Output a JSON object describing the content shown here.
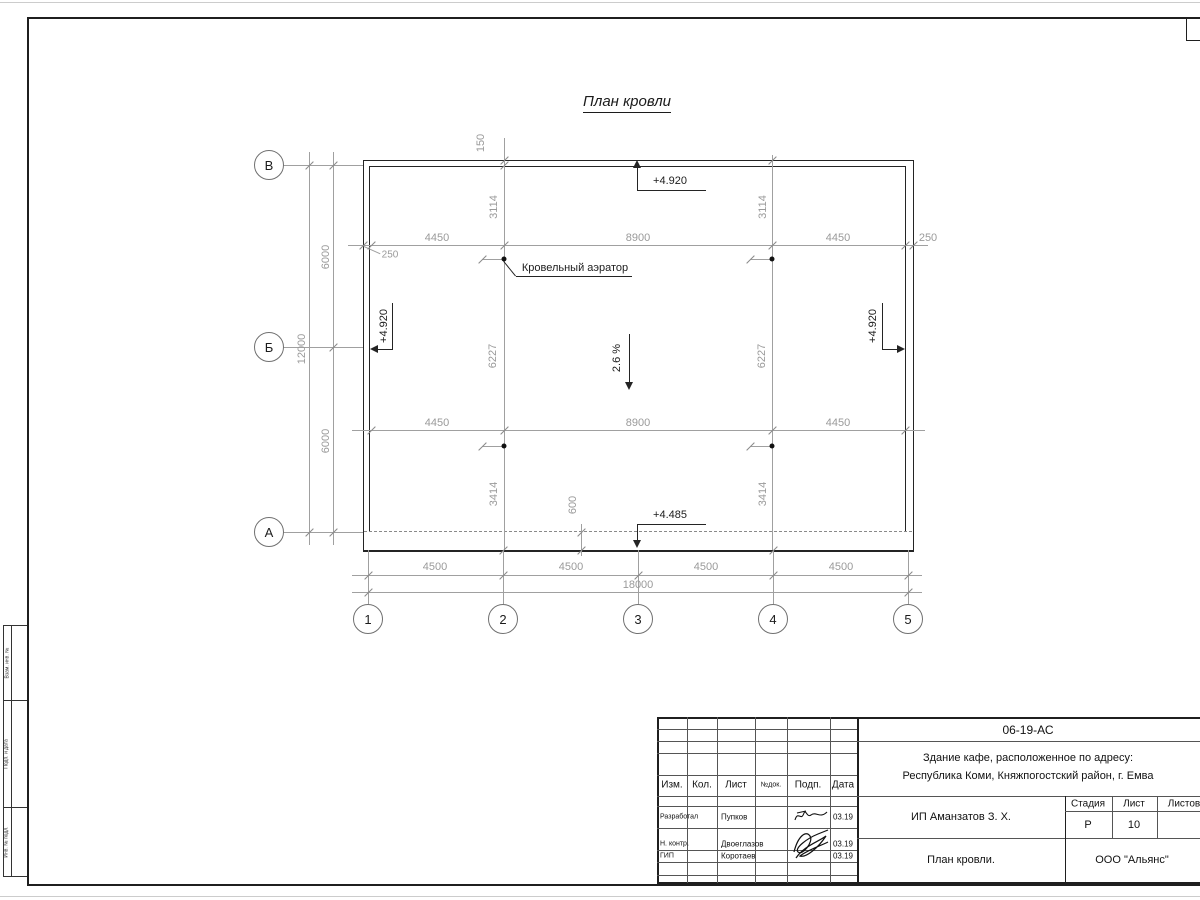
{
  "sheet": {
    "title": "План кровли"
  },
  "colors": {
    "line": "#242424",
    "dim": "#9a9a9a",
    "frame": "#1f1f1f"
  },
  "plan": {
    "axes_left": [
      "В",
      "Б",
      "А"
    ],
    "axes_bottom": [
      "1",
      "2",
      "3",
      "4",
      "5"
    ],
    "dims": {
      "top": [
        "250",
        "4450",
        "8900",
        "4450",
        "250"
      ],
      "mid": [
        "4450",
        "8900",
        "4450"
      ],
      "bottom": [
        "4500",
        "4500",
        "4500",
        "4500"
      ],
      "total_width": "18000",
      "left": [
        "6000",
        "6000"
      ],
      "total_height": "12000",
      "overhang_top": "150",
      "overhang_bottom": "600",
      "v_top_left": "3114",
      "v_top_right": "3114",
      "v_mid_left": "6227",
      "v_mid_right": "6227",
      "v_bot_left": "3414",
      "v_bot_right": "3414"
    },
    "elevations": {
      "top": "+4.920",
      "left": "+4.920",
      "right": "+4.920",
      "eaves": "+4.485"
    },
    "slope_label": "2.6 %",
    "aerator_label": "Кровельный аэратор"
  },
  "frame": {
    "side_labels": [
      "Взам. инв. №",
      "Подп. и дата",
      "Инв. № подл."
    ]
  },
  "title_block": {
    "doc_number": "06-19-АС",
    "project_address_line1": "Здание кафе, расположенное по адресу:",
    "project_address_line2": "Республика Коми, Княжпогостский район, г. Емва",
    "client": "ИП Аманзатов З. Х.",
    "sheet_name": "План кровли.",
    "company": "ООО \"Альянс\"",
    "rev_columns": [
      "Изм.",
      "Кол.",
      "Лист",
      "№док.",
      "Подп.",
      "Дата"
    ],
    "stage_columns": [
      "Стадия",
      "Лист",
      "Листов"
    ],
    "stage_value": "Р",
    "sheet_value": "10",
    "sheets_value": "",
    "roles": [
      {
        "role": "Разработал",
        "name": "Пупков",
        "date": "03.19"
      },
      {
        "role": "Н. контр.",
        "name": "Двоеглазов",
        "date": "03.19"
      },
      {
        "role": "ГИП",
        "name": "Коротаев",
        "date": "03.19"
      }
    ]
  }
}
